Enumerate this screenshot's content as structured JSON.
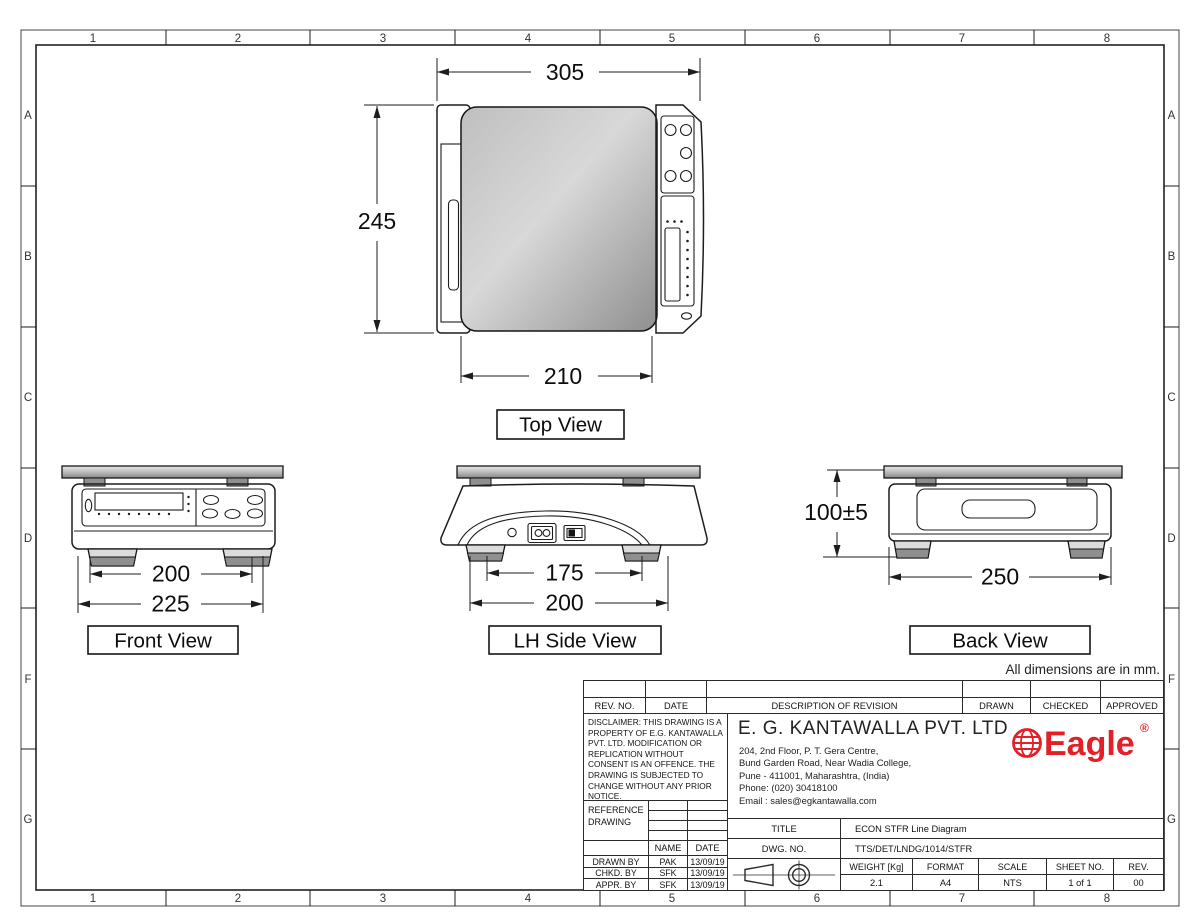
{
  "sheet": {
    "note": "All dimensions are in mm."
  },
  "border": {
    "cols": [
      "1",
      "2",
      "3",
      "4",
      "5",
      "6",
      "7",
      "8"
    ],
    "rows": [
      "A",
      "B",
      "C",
      "D",
      "F",
      "G"
    ]
  },
  "views": {
    "top": {
      "label": "Top View",
      "dim_width": "305",
      "dim_depth": "245",
      "dim_platter": "210"
    },
    "front": {
      "label": "Front View",
      "dim_feet": "200",
      "dim_overall": "225"
    },
    "side": {
      "label": "LH Side View",
      "dim_feet": "175",
      "dim_overall": "200"
    },
    "back": {
      "label": "Back View",
      "dim_height": "100±5",
      "dim_width": "250"
    }
  },
  "title_block": {
    "revision_headers": [
      "REV. NO.",
      "DATE",
      "DESCRIPTION OF REVISION",
      "DRAWN",
      "CHECKED",
      "APPROVED"
    ],
    "disclaimer": "DISCLAIMER: THIS DRAWING IS A PROPERTY OF E.G. KANTAWALLA PVT. LTD. MODIFICATION OR REPLICATION WITHOUT CONSENT IS AN OFFENCE. THE DRAWING IS SUBJECTED TO CHANGE WITHOUT ANY PRIOR NOTICE.",
    "reference_label_lines": [
      "REFERENCE",
      "DRAWING"
    ],
    "company": {
      "name": "E. G. KANTAWALLA PVT. LTD",
      "address_lines": [
        "204, 2nd Floor, P. T. Gera Centre,",
        "Bund Garden Road, Near Wadia College,",
        "Pune - 411001, Maharashtra, (India)",
        "Phone: (020) 30418100",
        "Email : sales@egkantawalla.com"
      ],
      "logo_text": "Eagle",
      "logo_reg": "®",
      "logo_color": "#e32028"
    },
    "name_header": "NAME",
    "date_header": "DATE",
    "signoff": [
      {
        "role": "DRAWN BY",
        "name": "PAK",
        "date": "13/09/19"
      },
      {
        "role": "CHKD. BY",
        "name": "SFK",
        "date": "13/09/19"
      },
      {
        "role": "APPR. BY",
        "name": "SFK",
        "date": "13/09/19"
      }
    ],
    "title_label": "TITLE",
    "title_value": "ECON STFR Line Diagram",
    "dwg_label": "DWG. NO.",
    "dwg_value": "TTS/DET/LNDG/1014/STFR",
    "spec_headers": [
      "WEIGHT [Kg]",
      "FORMAT",
      "SCALE",
      "SHEET NO.",
      "REV."
    ],
    "spec_values": [
      "2.1",
      "A4",
      "NTS",
      "1 of 1",
      "00"
    ]
  }
}
